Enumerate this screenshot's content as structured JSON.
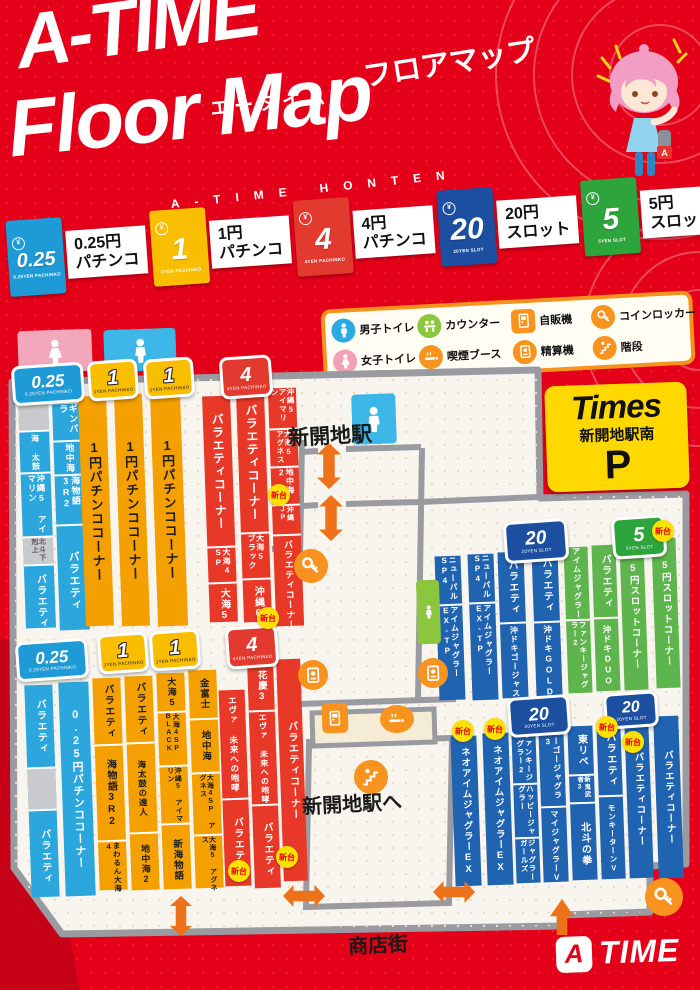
{
  "header": {
    "title": "A-TIME",
    "title_kana": "フロアマップ",
    "furigana": "エータイム",
    "title_en": "Floor Map",
    "tagline": "A-TIME HONTEN"
  },
  "rate_legend": {
    "items": [
      {
        "value": "0.25",
        "sub": "0.25YEN PACHINKO",
        "line1": "0.25円",
        "line2": "パチンコ",
        "color": "#1e9ad6"
      },
      {
        "value": "1",
        "sub": "1YEN PACHINKO",
        "line1": "1円",
        "line2": "パチンコ",
        "color": "#f9be00"
      },
      {
        "value": "4",
        "sub": "4YEN PACHINKO",
        "line1": "4円",
        "line2": "パチンコ",
        "color": "#e23a2e"
      },
      {
        "value": "20",
        "sub": "20YEN SLOT",
        "line1": "20円",
        "line2": "スロット",
        "color": "#1c4fa0"
      },
      {
        "value": "5",
        "sub": "5YEN SLOT",
        "line1": "5円",
        "line2": "スロット",
        "color": "#2ea43c"
      }
    ]
  },
  "icon_legend": {
    "items": [
      {
        "glyph": "male",
        "label": "男子トイレ",
        "color": "#29abe2",
        "shape": "circle"
      },
      {
        "glyph": "counter",
        "label": "カウンター",
        "color": "#8cc63f",
        "shape": "circle"
      },
      {
        "glyph": "vending",
        "label": "自販機",
        "color": "#f7931e",
        "shape": "square"
      },
      {
        "glyph": "locker",
        "label": "コインロッカー",
        "color": "#f7931e",
        "shape": "circle"
      },
      {
        "glyph": "female",
        "label": "女子トイレ",
        "color": "#f2a0b4",
        "shape": "circle"
      },
      {
        "glyph": "smoking",
        "label": "喫煙ブース",
        "color": "#f7931e",
        "shape": "circle"
      },
      {
        "glyph": "payout",
        "label": "精算機",
        "color": "#f7931e",
        "shape": "circle"
      },
      {
        "glyph": "stairs",
        "label": "階段",
        "color": "#f7931e",
        "shape": "circle"
      }
    ]
  },
  "parking_sign": {
    "brand": "Times",
    "name": "新開地駅南",
    "mark": "P"
  },
  "labels": {
    "station": "新開地駅",
    "to_station": "新開地駅へ",
    "street": "商店街",
    "new_unit": "新台"
  },
  "logo": {
    "mark": "A",
    "rest": "TIME"
  },
  "map": {
    "colors": {
      "p025": "#2ba7dd",
      "p1": "#f4a000",
      "p4": "#e73828",
      "s20": "#2063b0",
      "s5": "#5fb54d",
      "gray": "#c9cacd"
    },
    "strips": [
      {
        "x": 22,
        "y": 400,
        "w": 30,
        "h": 228,
        "c": "p025",
        "seg": [
          {
            "t": "",
            "c": "gray",
            "f": 30
          },
          {
            "t": "海 太鼓",
            "fs": 8,
            "f": 40
          },
          {
            "t": "沖縄5 アイマリン",
            "fs": 8.5,
            "f": 62
          },
          {
            "t": "北斗下剋上",
            "fs": 7,
            "c": "gray",
            "f": 26
          },
          {
            "t": "バラエティ",
            "fs": 10,
            "f": 70
          }
        ]
      },
      {
        "x": 56,
        "y": 404,
        "w": 30,
        "h": 226,
        "c": "p025",
        "seg": [
          {
            "t": "ギンパラ",
            "fs": 9,
            "f": 36
          },
          {
            "t": "地中海",
            "fs": 9,
            "f": 32
          },
          {
            "t": "海物語3R2",
            "fs": 9,
            "f": 48
          },
          {
            "t": "バラエティ",
            "fs": 11,
            "f": 110
          }
        ]
      },
      {
        "x": 82,
        "y": 396,
        "w": 28,
        "h": 230,
        "c": "p1",
        "seg": [
          {
            "t": "1円パチンココーナー",
            "fs": 13
          }
        ]
      },
      {
        "x": 118,
        "y": 394,
        "w": 28,
        "h": 232,
        "c": "p1",
        "seg": [
          {
            "t": "1円パチンココーナー",
            "fs": 13
          }
        ]
      },
      {
        "x": 154,
        "y": 392,
        "w": 30,
        "h": 234,
        "c": "p1",
        "seg": [
          {
            "t": "1円パチンココーナー",
            "fs": 13
          }
        ]
      },
      {
        "x": 206,
        "y": 396,
        "w": 28,
        "h": 226,
        "c": "p4",
        "seg": [
          {
            "t": "バラエティコーナー",
            "fs": 12,
            "f": 150
          },
          {
            "t": "大海4 SP",
            "fs": 8,
            "f": 34
          },
          {
            "t": "大海5",
            "fs": 10,
            "f": 42
          }
        ]
      },
      {
        "x": 240,
        "y": 392,
        "w": 28,
        "h": 230,
        "c": "p4",
        "seg": [
          {
            "t": "バラエティコーナー",
            "fs": 12,
            "f": 140
          },
          {
            "t": "大海5 ブラック",
            "fs": 8,
            "f": 44
          },
          {
            "t": "沖縄6",
            "fs": 10,
            "f": 46
          }
        ]
      },
      {
        "x": 272,
        "y": 388,
        "w": 28,
        "h": 238,
        "c": "p4",
        "seg": [
          {
            "t": "沖縄5 アイマリン",
            "fs": 7.5,
            "f": 40
          },
          {
            "t": "大海5 アグネス",
            "fs": 7.5,
            "f": 36
          },
          {
            "t": "地中海2",
            "fs": 8,
            "f": 36
          },
          {
            "t": "沖縄JP",
            "fs": 7,
            "f": 28
          },
          {
            "t": "バラエティコーナー",
            "fs": 9,
            "f": 98
          }
        ]
      },
      {
        "x": 437,
        "y": 556,
        "w": 26,
        "h": 144,
        "c": "s20",
        "seg": [
          {
            "t": "ニューパル SP4",
            "fs": 8,
            "f": 48
          },
          {
            "t": "アイムジャグラー EX-TP",
            "fs": 8,
            "f": 96
          }
        ]
      },
      {
        "x": 470,
        "y": 554,
        "w": 26,
        "h": 146,
        "c": "s20",
        "seg": [
          {
            "t": "ニューパル SP4",
            "fs": 8,
            "f": 48
          },
          {
            "t": "アイムジャグラー EX-TP",
            "fs": 8,
            "f": 98
          }
        ]
      },
      {
        "x": 500,
        "y": 552,
        "w": 26,
        "h": 146,
        "c": "s20",
        "seg": [
          {
            "t": "バラエティ",
            "fs": 10,
            "f": 70
          },
          {
            "t": "沖ドキゴージャス",
            "fs": 8,
            "f": 76
          }
        ]
      },
      {
        "x": 534,
        "y": 549,
        "w": 26,
        "h": 148,
        "c": "s20",
        "seg": [
          {
            "t": "バラエティ",
            "fs": 10,
            "f": 72
          },
          {
            "t": "沖ドキGOLD",
            "fs": 8.5,
            "f": 76
          }
        ]
      },
      {
        "x": 566,
        "y": 547,
        "w": 24,
        "h": 146,
        "c": "s5",
        "seg": [
          {
            "t": "アイムジャグラー",
            "fs": 8,
            "f": 72
          },
          {
            "t": "ファンキージャグラー2",
            "fs": 7.5,
            "f": 74
          }
        ]
      },
      {
        "x": 594,
        "y": 545,
        "w": 24,
        "h": 146,
        "c": "s5",
        "seg": [
          {
            "t": "バラエティ",
            "fs": 10,
            "f": 72
          },
          {
            "t": "沖ドキDUO",
            "fs": 8.5,
            "f": 74
          }
        ]
      },
      {
        "x": 622,
        "y": 542,
        "w": 24,
        "h": 148,
        "c": "s5",
        "seg": [
          {
            "t": "5円スロットコーナー",
            "fs": 9.5
          }
        ]
      },
      {
        "x": 654,
        "y": 538,
        "w": 24,
        "h": 150,
        "c": "s5",
        "seg": [
          {
            "t": "5円スロットコーナー",
            "fs": 9.5
          }
        ]
      },
      {
        "x": 28,
        "y": 685,
        "w": 28,
        "h": 212,
        "c": "p025",
        "seg": [
          {
            "t": "バラエティ",
            "fs": 10,
            "f": 82
          },
          {
            "t": "",
            "c": "gray",
            "f": 40
          },
          {
            "t": "バラエティ",
            "fs": 10,
            "f": 90
          }
        ]
      },
      {
        "x": 62,
        "y": 682,
        "w": 30,
        "h": 214,
        "c": "p025",
        "seg": [
          {
            "t": "0.25円パチンココーナー",
            "fs": 11
          }
        ]
      },
      {
        "x": 96,
        "y": 678,
        "w": 28,
        "h": 212,
        "c": "p1",
        "seg": [
          {
            "t": "バラエティ",
            "fs": 10,
            "f": 66
          },
          {
            "t": "海物語3R2",
            "fs": 10,
            "f": 94
          },
          {
            "t": "まわるん大海4",
            "fs": 7.5,
            "f": 52
          }
        ]
      },
      {
        "x": 128,
        "y": 676,
        "w": 28,
        "h": 214,
        "c": "p1",
        "seg": [
          {
            "t": "バラエティ",
            "fs": 10,
            "f": 66
          },
          {
            "t": "海太鼓の達人",
            "fs": 8.5,
            "f": 88
          },
          {
            "t": "地中海2",
            "fs": 9,
            "f": 60
          }
        ]
      },
      {
        "x": 160,
        "y": 673,
        "w": 28,
        "h": 216,
        "c": "p1",
        "seg": [
          {
            "t": "大海5",
            "fs": 9,
            "f": 38
          },
          {
            "t": "大海4SP BLACK",
            "fs": 7,
            "f": 52
          },
          {
            "t": "沖縄5 アイマリン",
            "fs": 7,
            "f": 56
          },
          {
            "t": "新海物語",
            "fs": 9.5,
            "f": 70
          }
        ]
      },
      {
        "x": 192,
        "y": 670,
        "w": 28,
        "h": 218,
        "c": "p1",
        "seg": [
          {
            "t": "金富士",
            "fs": 9.5,
            "f": 48
          },
          {
            "t": "地中海",
            "fs": 9.5,
            "f": 52
          },
          {
            "t": "大海4SP アグネス",
            "fs": 7,
            "f": 60
          },
          {
            "t": "大海5 アグネス",
            "fs": 7,
            "f": 58
          }
        ]
      },
      {
        "x": 222,
        "y": 690,
        "w": 26,
        "h": 196,
        "c": "p4",
        "seg": [
          {
            "t": "エヴァ 未来への咆哮",
            "fs": 8.5,
            "f": 108
          },
          {
            "t": "バラエティ",
            "fs": 10,
            "f": 88
          }
        ]
      },
      {
        "x": 251,
        "y": 662,
        "w": 26,
        "h": 226,
        "c": "p4",
        "seg": [
          {
            "t": "花慶3",
            "fs": 9.5,
            "f": 48
          },
          {
            "t": "エヴァ 未来への咆哮",
            "fs": 8,
            "f": 92
          },
          {
            "t": "バラエティ",
            "fs": 10,
            "f": 86
          }
        ]
      },
      {
        "x": 280,
        "y": 659,
        "w": 24,
        "h": 222,
        "c": "p4",
        "seg": [
          {
            "t": "バラエティコーナー",
            "fs": 10
          }
        ]
      },
      {
        "x": 453,
        "y": 736,
        "w": 26,
        "h": 150,
        "c": "s20",
        "seg": [
          {
            "t": "ネオアイムジャグラーEX",
            "fs": 9.5
          }
        ]
      },
      {
        "x": 485,
        "y": 733,
        "w": 26,
        "h": 152,
        "c": "s20",
        "seg": [
          {
            "t": "ネオアイムジャグラーEX",
            "fs": 9.5
          }
        ]
      },
      {
        "x": 514,
        "y": 731,
        "w": 24,
        "h": 152,
        "c": "s20",
        "seg": [
          {
            "t": "ファンキージャグラー2",
            "fs": 7.5,
            "f": 52
          },
          {
            "t": "ハッピージャグラー",
            "fs": 7.5,
            "f": 52
          },
          {
            "t": "ジャグラーガールズ",
            "fs": 7.5,
            "f": 48
          }
        ]
      },
      {
        "x": 541,
        "y": 728,
        "w": 25,
        "h": 154,
        "c": "s20",
        "seg": [
          {
            "t": "ゴーゴージャグラー3",
            "fs": 8,
            "f": 78
          },
          {
            "t": "マイジャグラーV",
            "fs": 8,
            "f": 76
          }
        ]
      },
      {
        "x": 570,
        "y": 726,
        "w": 25,
        "h": 154,
        "c": "s20",
        "seg": [
          {
            "t": "東リベ",
            "fs": 10,
            "f": 48
          },
          {
            "t": "新鬼武者3",
            "fs": 6.5,
            "f": 26
          },
          {
            "t": "北斗の拳",
            "fs": 10,
            "f": 80
          }
        ]
      },
      {
        "x": 599,
        "y": 723,
        "w": 24,
        "h": 156,
        "c": "s20",
        "seg": [
          {
            "t": "バラエティ",
            "fs": 10,
            "f": 72
          },
          {
            "t": "モンキーターンV",
            "fs": 7.5,
            "f": 84
          }
        ]
      },
      {
        "x": 627,
        "y": 720,
        "w": 24,
        "h": 158,
        "c": "s20",
        "seg": [
          {
            "t": "バラエティコーナー",
            "fs": 9.5
          }
        ]
      },
      {
        "x": 656,
        "y": 716,
        "w": 25,
        "h": 162,
        "c": "s20",
        "seg": [
          {
            "t": "バラエティコーナー",
            "fs": 9.5
          }
        ]
      }
    ],
    "badges": [
      {
        "t": "0.25",
        "sub": "0.25YEN PACHINKO",
        "c": "#1e9ad6",
        "x": 12,
        "y": 364,
        "w": 66,
        "h": 34,
        "fs": 17
      },
      {
        "t": "1",
        "sub": "1YEN PACHINKO",
        "c": "#f9be00",
        "x": 88,
        "y": 360,
        "w": 44,
        "h": 34,
        "fs": 20,
        "dark": true
      },
      {
        "t": "1",
        "sub": "1YEN PACHINKO",
        "c": "#f9be00",
        "x": 144,
        "y": 358,
        "w": 44,
        "h": 34,
        "fs": 20,
        "dark": true
      },
      {
        "t": "4",
        "sub": "4YEN PACHINKO",
        "c": "#e23a2e",
        "x": 220,
        "y": 356,
        "w": 46,
        "h": 36,
        "fs": 20
      },
      {
        "t": "20",
        "sub": "20YEN SLOT",
        "c": "#1c4fa0",
        "x": 504,
        "y": 520,
        "w": 58,
        "h": 36,
        "fs": 19
      },
      {
        "t": "5",
        "sub": "5YEN SLOT",
        "c": "#2ea43c",
        "x": 612,
        "y": 516,
        "w": 48,
        "h": 36,
        "fs": 20
      },
      {
        "t": "0.25",
        "sub": "0.25YEN PACHINKO",
        "c": "#1e9ad6",
        "x": 16,
        "y": 640,
        "w": 66,
        "h": 34,
        "fs": 17
      },
      {
        "t": "1",
        "sub": "1YEN PACHINKO",
        "c": "#f9be00",
        "x": 98,
        "y": 633,
        "w": 44,
        "h": 34,
        "fs": 20,
        "dark": true
      },
      {
        "t": "1",
        "sub": "1YEN PACHINKO",
        "c": "#f9be00",
        "x": 150,
        "y": 630,
        "w": 44,
        "h": 34,
        "fs": 20,
        "dark": true
      },
      {
        "t": "4",
        "sub": "4YEN PACHINKO",
        "c": "#e23a2e",
        "x": 226,
        "y": 626,
        "w": 46,
        "h": 36,
        "fs": 20
      },
      {
        "t": "20",
        "sub": "20YEN SLOT",
        "c": "#1c4fa0",
        "x": 508,
        "y": 696,
        "w": 56,
        "h": 34,
        "fs": 18
      },
      {
        "t": "20",
        "sub": "20YEN SLOT",
        "c": "#1c4fa0",
        "x": 604,
        "y": 692,
        "w": 48,
        "h": 30,
        "fs": 16
      }
    ],
    "new_badges": [
      {
        "x": 268,
        "y": 484
      },
      {
        "x": 257,
        "y": 607
      },
      {
        "x": 652,
        "y": 520
      },
      {
        "x": 228,
        "y": 860
      },
      {
        "x": 276,
        "y": 846
      },
      {
        "x": 452,
        "y": 720
      },
      {
        "x": 484,
        "y": 718
      },
      {
        "x": 596,
        "y": 716
      },
      {
        "x": 622,
        "y": 731
      }
    ],
    "markers": [
      {
        "glyph": "female",
        "name": "female-toilet-marker",
        "shape": "rect",
        "x": 18,
        "y": 330,
        "w": 74,
        "h": 42,
        "c": "#f2a8ba"
      },
      {
        "glyph": "male",
        "name": "male-toilet-marker",
        "shape": "rect",
        "x": 104,
        "y": 329,
        "w": 72,
        "h": 42,
        "c": "#3cb7e8"
      },
      {
        "glyph": "male",
        "name": "male-toilet-marker",
        "shape": "rect",
        "x": 352,
        "y": 394,
        "w": 44,
        "h": 50,
        "c": "#3cb7e8"
      },
      {
        "glyph": "male",
        "name": "counter-marker",
        "shape": "rect",
        "x": 417,
        "y": 580,
        "w": 23,
        "h": 64,
        "c": "#8cc63f"
      },
      {
        "glyph": "locker",
        "name": "coin-locker-marker",
        "shape": "circle",
        "x": 294,
        "y": 549,
        "w": 34,
        "h": 34,
        "c": "#f7931e"
      },
      {
        "glyph": "payout",
        "name": "payout-machine-marker",
        "shape": "circle",
        "x": 298,
        "y": 660,
        "w": 30,
        "h": 30,
        "c": "#f7931e"
      },
      {
        "glyph": "payout",
        "name": "payout-machine-marker",
        "shape": "circle",
        "x": 418,
        "y": 658,
        "w": 30,
        "h": 30,
        "c": "#f7931e"
      },
      {
        "glyph": "vending",
        "name": "vending-machine-marker",
        "shape": "square",
        "x": 322,
        "y": 703,
        "w": 26,
        "h": 30,
        "c": "#f7931e"
      },
      {
        "glyph": "smoking",
        "name": "smoking-booth-marker",
        "shape": "circle",
        "x": 380,
        "y": 705,
        "w": 34,
        "h": 28,
        "c": "#f7931e"
      },
      {
        "glyph": "stairs",
        "name": "stairs-marker",
        "shape": "circle",
        "x": 354,
        "y": 760,
        "w": 34,
        "h": 34,
        "c": "#f7931e"
      },
      {
        "glyph": "locker",
        "name": "coin-locker-marker",
        "shape": "circle",
        "x": 645,
        "y": 878,
        "w": 38,
        "h": 38,
        "c": "#f7931e"
      }
    ],
    "arrows": [
      {
        "o": "v",
        "x": 317,
        "y": 443,
        "w": 24,
        "h": 46
      },
      {
        "o": "v",
        "x": 319,
        "y": 495,
        "w": 24,
        "h": 46
      },
      {
        "o": "v",
        "x": 170,
        "y": 896,
        "w": 22,
        "h": 40
      },
      {
        "o": "h",
        "x": 283,
        "y": 885,
        "w": 42,
        "h": 22
      },
      {
        "o": "h",
        "x": 433,
        "y": 881,
        "w": 42,
        "h": 22
      },
      {
        "o": "u",
        "x": 550,
        "y": 899,
        "w": 24,
        "h": 36
      }
    ]
  }
}
